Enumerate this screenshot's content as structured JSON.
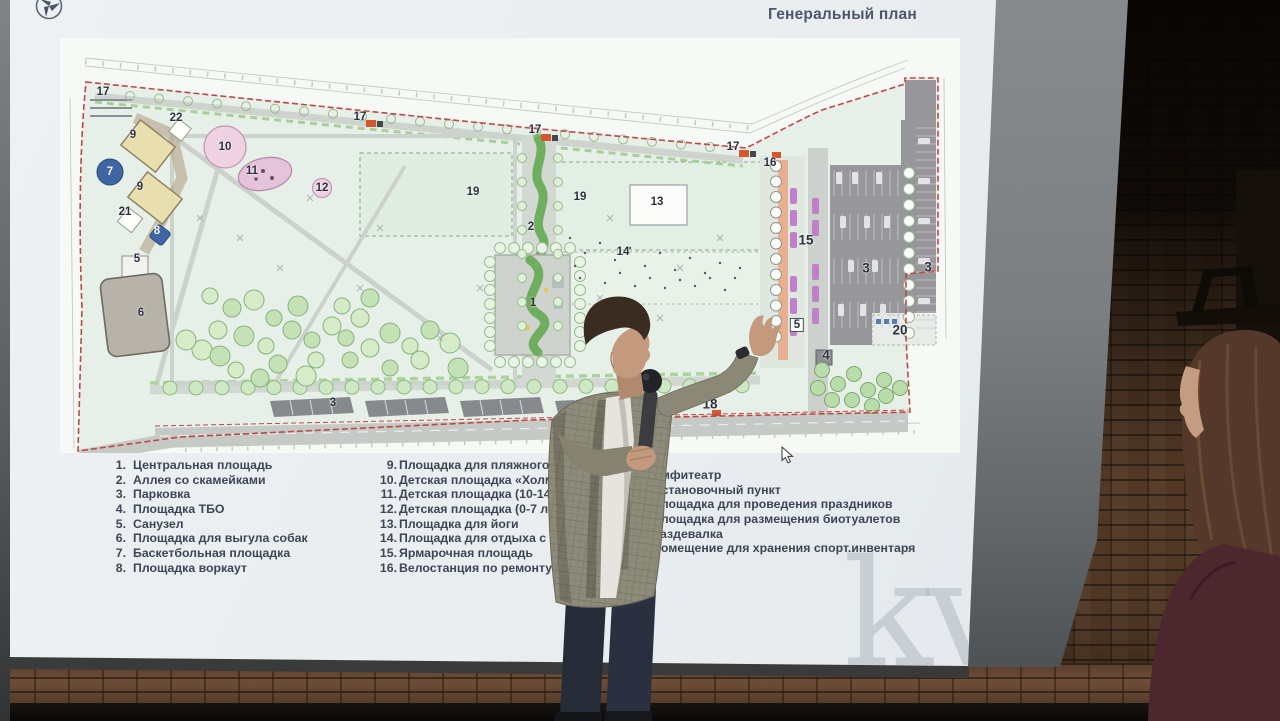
{
  "slide": {
    "title": "Генеральный план",
    "watermark": "kv",
    "legend_col1": [
      {
        "num": "1.",
        "label": "Центральная площадь"
      },
      {
        "num": "2.",
        "label": "Аллея со скамейками"
      },
      {
        "num": "3.",
        "label": "Парковка"
      },
      {
        "num": "4.",
        "label": "Площадка ТБО"
      },
      {
        "num": "5.",
        "label": "Санузел"
      },
      {
        "num": "6.",
        "label": "Площадка для выгула собак"
      },
      {
        "num": "7.",
        "label": "Баскетбольная площадка"
      },
      {
        "num": "8.",
        "label": "Площадка воркаут"
      }
    ],
    "legend_col2": [
      {
        "num": "9.",
        "label": "Площадка для пляжного вол"
      },
      {
        "num": "10.",
        "label": "Детская площадка «Холм» (7"
      },
      {
        "num": "11.",
        "label": "Детская площадка (10-14 лет"
      },
      {
        "num": "12.",
        "label": "Детская площадка (0-7 лет)"
      },
      {
        "num": "13.",
        "label": "Площадка для йоги"
      },
      {
        "num": "14.",
        "label": "Площадка для отдыха с ше"
      },
      {
        "num": "15.",
        "label": "Ярмарочная площадь"
      },
      {
        "num": "16.",
        "label": "Велостанция по ремонту"
      }
    ],
    "legend_col3": [
      {
        "num": "17.",
        "label": "Амфитеатр"
      },
      {
        "num": "18.",
        "label": "Остановочный пункт"
      },
      {
        "num": "19.",
        "label": "Площадка для проведения праздников"
      },
      {
        "num": "20.",
        "label": "Площадка для размещения биотуалетов"
      },
      {
        "num": "21.",
        "label": "Раздевалка"
      },
      {
        "num": "22.",
        "label": "Помещение для хранения спорт.инвентаря"
      }
    ],
    "plan_labels": [
      {
        "t": "17",
        "x": 43,
        "y": 54
      },
      {
        "t": "22",
        "x": 116,
        "y": 80
      },
      {
        "t": "9",
        "x": 73,
        "y": 97
      },
      {
        "t": "10",
        "x": 165,
        "y": 109
      },
      {
        "t": "11",
        "x": 192,
        "y": 133
      },
      {
        "t": "7",
        "x": 50,
        "y": 134,
        "inv": true
      },
      {
        "t": "9",
        "x": 80,
        "y": 149
      },
      {
        "t": "12",
        "x": 262,
        "y": 150
      },
      {
        "t": "21",
        "x": 65,
        "y": 174
      },
      {
        "t": "8",
        "x": 97,
        "y": 193,
        "inv": true
      },
      {
        "t": "5",
        "x": 77,
        "y": 221
      },
      {
        "t": "6",
        "x": 81,
        "y": 275
      },
      {
        "t": "17",
        "x": 300,
        "y": 79
      },
      {
        "t": "17",
        "x": 475,
        "y": 92
      },
      {
        "t": "19",
        "x": 413,
        "y": 154
      },
      {
        "t": "2",
        "x": 471,
        "y": 189
      },
      {
        "t": "19",
        "x": 520,
        "y": 159
      },
      {
        "t": "13",
        "x": 597,
        "y": 164
      },
      {
        "t": "14",
        "x": 563,
        "y": 214
      },
      {
        "t": "1",
        "x": 473,
        "y": 265
      },
      {
        "t": "17",
        "x": 673,
        "y": 109
      },
      {
        "t": "16",
        "x": 710,
        "y": 125
      },
      {
        "t": "15",
        "x": 746,
        "y": 202,
        "lg": true
      },
      {
        "t": "3",
        "x": 806,
        "y": 230,
        "lg": true
      },
      {
        "t": "3",
        "x": 868,
        "y": 229,
        "lg": true
      },
      {
        "t": "20",
        "x": 840,
        "y": 292,
        "lg": true
      },
      {
        "t": "5",
        "x": 737,
        "y": 287,
        "chip": true
      },
      {
        "t": "4",
        "x": 766,
        "y": 317,
        "lg": true
      },
      {
        "t": "18",
        "x": 650,
        "y": 366,
        "lg": true
      },
      {
        "t": "3",
        "x": 273,
        "y": 365
      }
    ],
    "colors": {
      "boundary_red": "#c04747",
      "park_green": "#e6f0e8",
      "parking_gray": "#97979b",
      "court_sand": "#e9dfae",
      "playground_pink": "#eed2e2",
      "sport_blue": "#3f66a2",
      "stall_purple": "#c080c8"
    }
  }
}
